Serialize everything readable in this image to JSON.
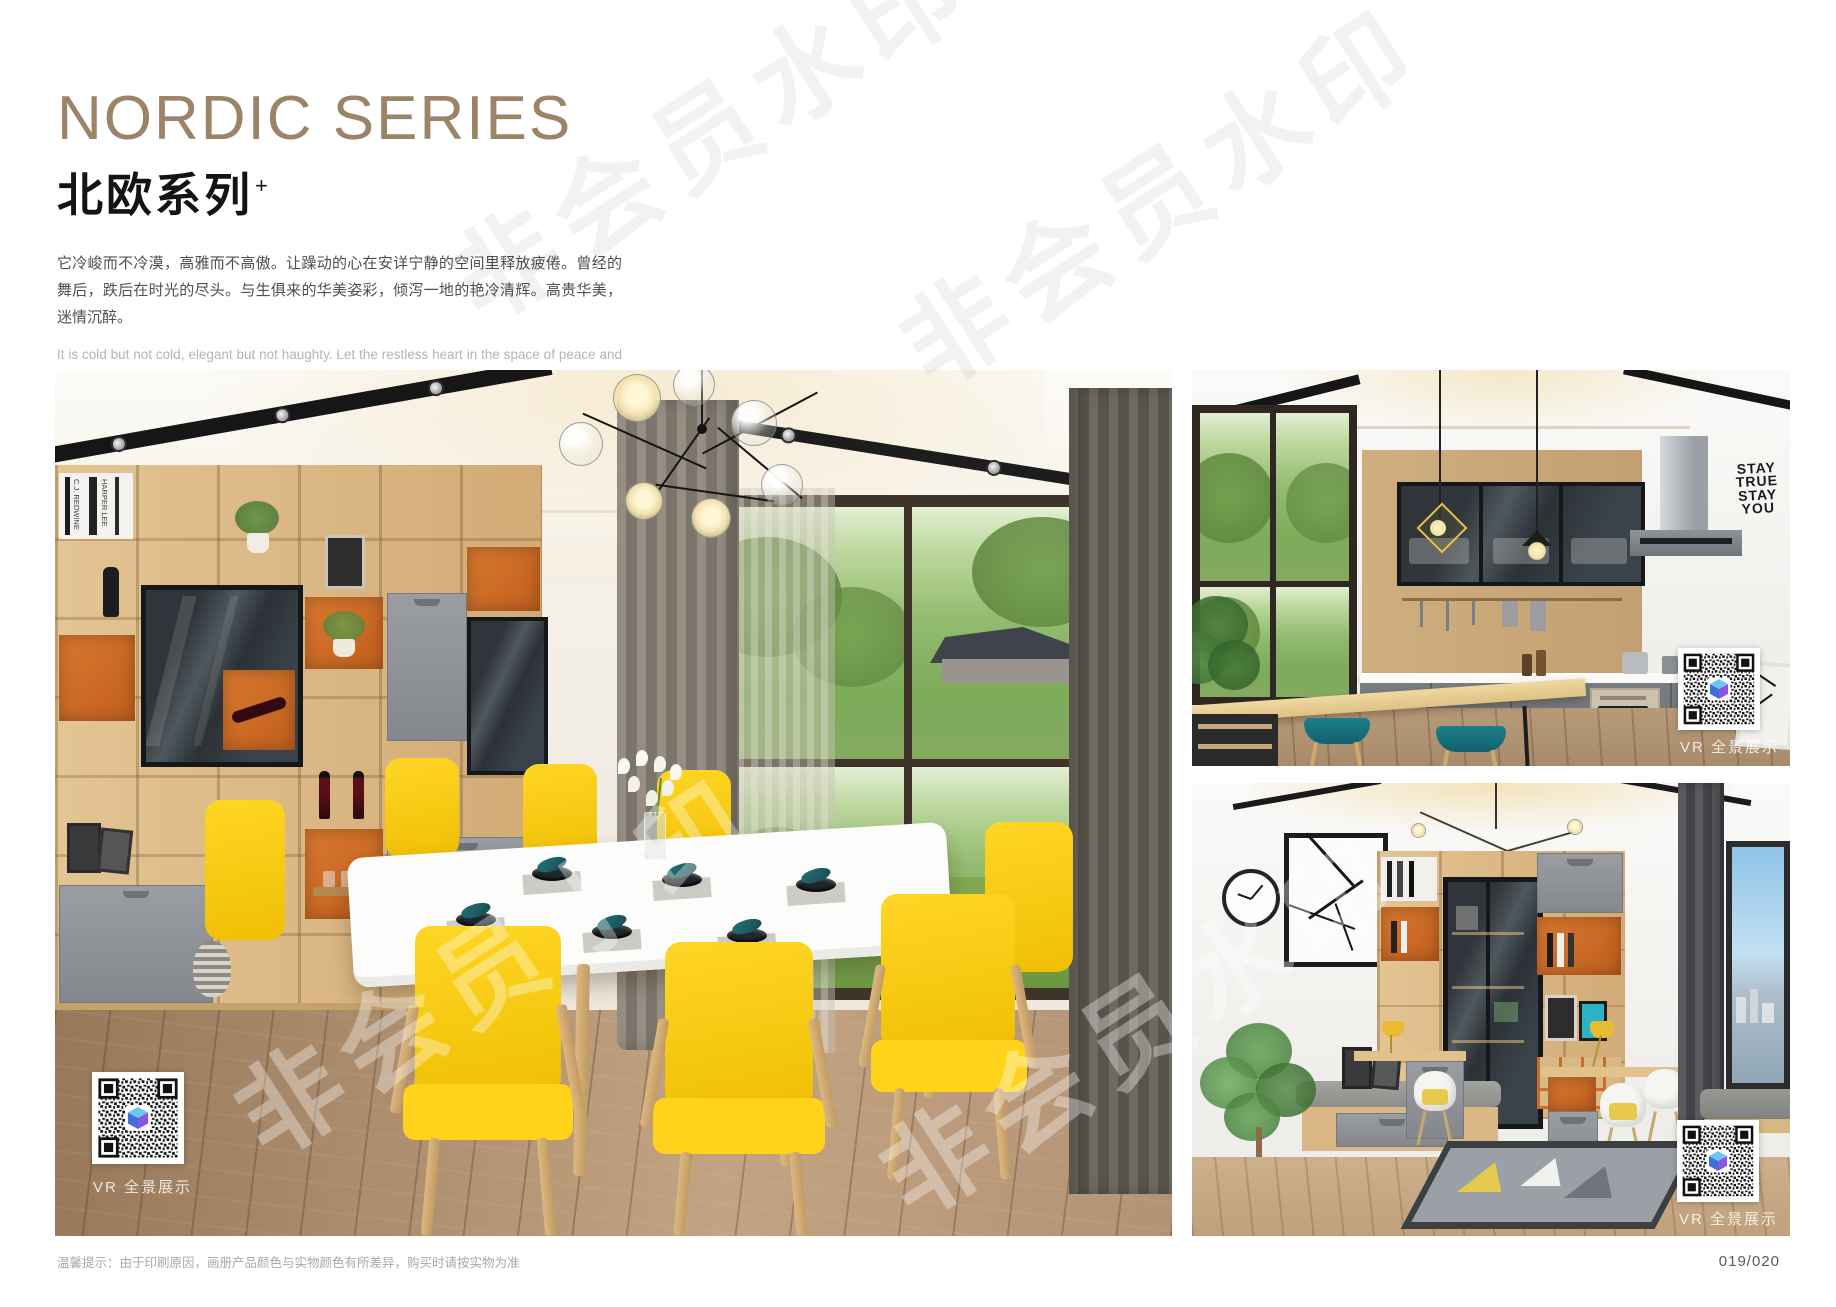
{
  "header": {
    "title_en": "NORDIC SERIES",
    "title_cn": "北欧系列",
    "title_sup": "+",
    "desc_cn": "它冷峻而不冷漠，高雅而不高傲。让躁动的心在安详宁静的空间里释放疲倦。曾经的舞后，跌后在时光的尽头。与生俱来的华美姿彩，倾泻一地的艳冷清辉。高贵华美，迷情沉醉。",
    "desc_en": "It is cold but not cold, elegant but not haughty. Let the restless heart in the space of peace and tranquility release fatigue. Once the Queen of Dance, fall in the end of time. The natural beauty of the beautiful, pouring a land of cold and pure brilliance. Noble, beautiful, enchanted.",
    "accent_color": "#9b8468"
  },
  "watermark": {
    "text": "非会员水印"
  },
  "photos": {
    "dining": {
      "name": "dining room with yellow chairs",
      "vr_label": "VR 全景展示",
      "books": {
        "b1": "C.J. REDWINE",
        "b2": "HARPER LEE"
      },
      "colors": {
        "cabinet_orange": "#cf6e2c",
        "chair_yellow": "#f7c900",
        "napkin_teal": "#1d5c60"
      }
    },
    "kitchen": {
      "name": "open kitchen with bar stools",
      "vr_label": "VR 全景展示",
      "wall_art": {
        "l1": "STAY",
        "l2": "TRUE",
        "l3": "STAY",
        "l4": "YOU"
      },
      "colors": {
        "stool_teal": "#177482"
      }
    },
    "study": {
      "name": "study room with bookcase",
      "vr_label": "VR 全景展示"
    }
  },
  "footer": {
    "note": "温馨提示：由于印刷原因，画册产品颜色与实物颜色有所差异，购买时请按实物为准",
    "page": "019/020"
  }
}
